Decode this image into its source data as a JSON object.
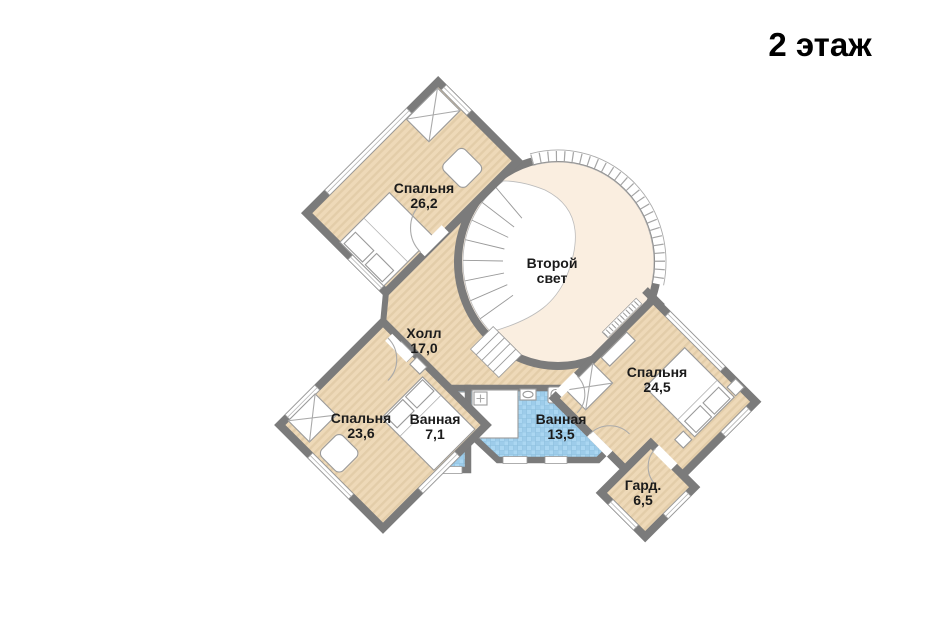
{
  "title": "2 этаж",
  "rooms": {
    "bedroom_top": {
      "label_lines": [
        "Спальня",
        "26,2"
      ]
    },
    "second_light": {
      "label_lines": [
        "Второй",
        "свет"
      ]
    },
    "hall": {
      "label_lines": [
        "Холл",
        "17,0"
      ]
    },
    "bedroom_right": {
      "label_lines": [
        "Спальня",
        "24,5"
      ]
    },
    "bedroom_left": {
      "label_lines": [
        "Спальня",
        "23,6"
      ]
    },
    "bath_small": {
      "label_lines": [
        "Ванная",
        "7,1"
      ]
    },
    "bath_big": {
      "label_lines": [
        "Ванная",
        "13,5"
      ]
    },
    "wardrobe": {
      "label_lines": [
        "Гард.",
        "6,5"
      ]
    }
  },
  "colors": {
    "wall": "#7b7b7b",
    "wood_floor": "#eed9b8",
    "wood_stripe": "#e3cda9",
    "tile_base": "#9dccea",
    "tile_light": "#abd7f2",
    "oval_floor": "#faeee0",
    "background": "#ffffff",
    "text": "#1b1b1b"
  }
}
